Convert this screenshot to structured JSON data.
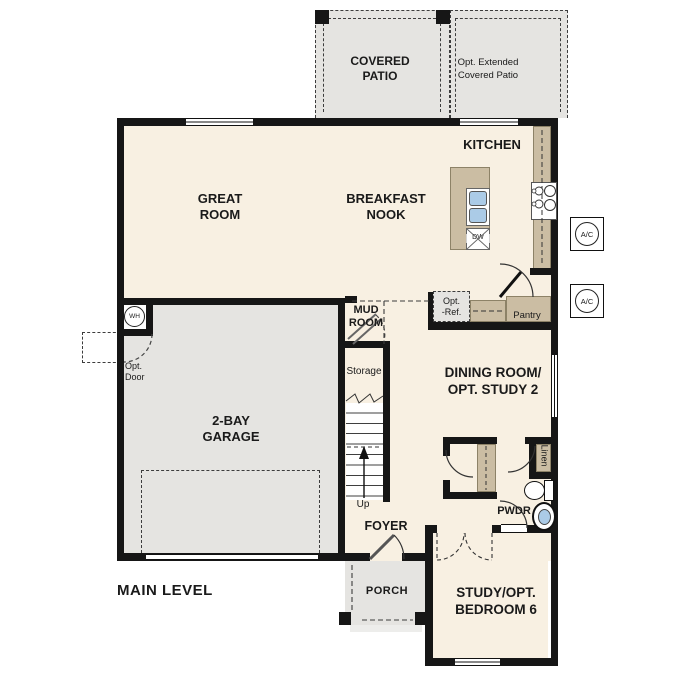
{
  "title": "MAIN LEVEL",
  "rooms": {
    "covered_patio": {
      "label": "COVERED\nPATIO"
    },
    "opt_extended_patio": {
      "label": "Opt. Extended\nCovered Patio"
    },
    "kitchen": {
      "label": "KITCHEN"
    },
    "great_room": {
      "label": "GREAT\nROOM"
    },
    "breakfast_nook": {
      "label": "BREAKFAST\nNOOK"
    },
    "mud_room": {
      "label": "MUD\nROOM"
    },
    "storage": {
      "label": "Storage"
    },
    "stairs_up": {
      "label": "Up"
    },
    "dining_room": {
      "label": "DINING ROOM/\nOPT. STUDY 2"
    },
    "garage": {
      "label": "2-BAY\nGARAGE"
    },
    "foyer": {
      "label": "FOYER"
    },
    "porch": {
      "label": "PORCH"
    },
    "study": {
      "label": "STUDY/OPT.\nBEDROOM 6"
    },
    "powder_room": {
      "label": "PWDR"
    },
    "pantry": {
      "label": "Pantry"
    },
    "linen": {
      "label": "Linen"
    }
  },
  "fixtures": {
    "water_heater": "WH",
    "ac_unit": "A/C",
    "dishwasher": "DW",
    "opt_refrigerator": "Opt.\n-Ref.",
    "opt_door": "Opt.\nDoor"
  },
  "colors": {
    "floor": "#f8f0e2",
    "hardscape": "#e5e4e1",
    "counter": "#cbbda3",
    "wall": "#161616",
    "sink_blue": "#abcbe7",
    "line": "#333333"
  }
}
